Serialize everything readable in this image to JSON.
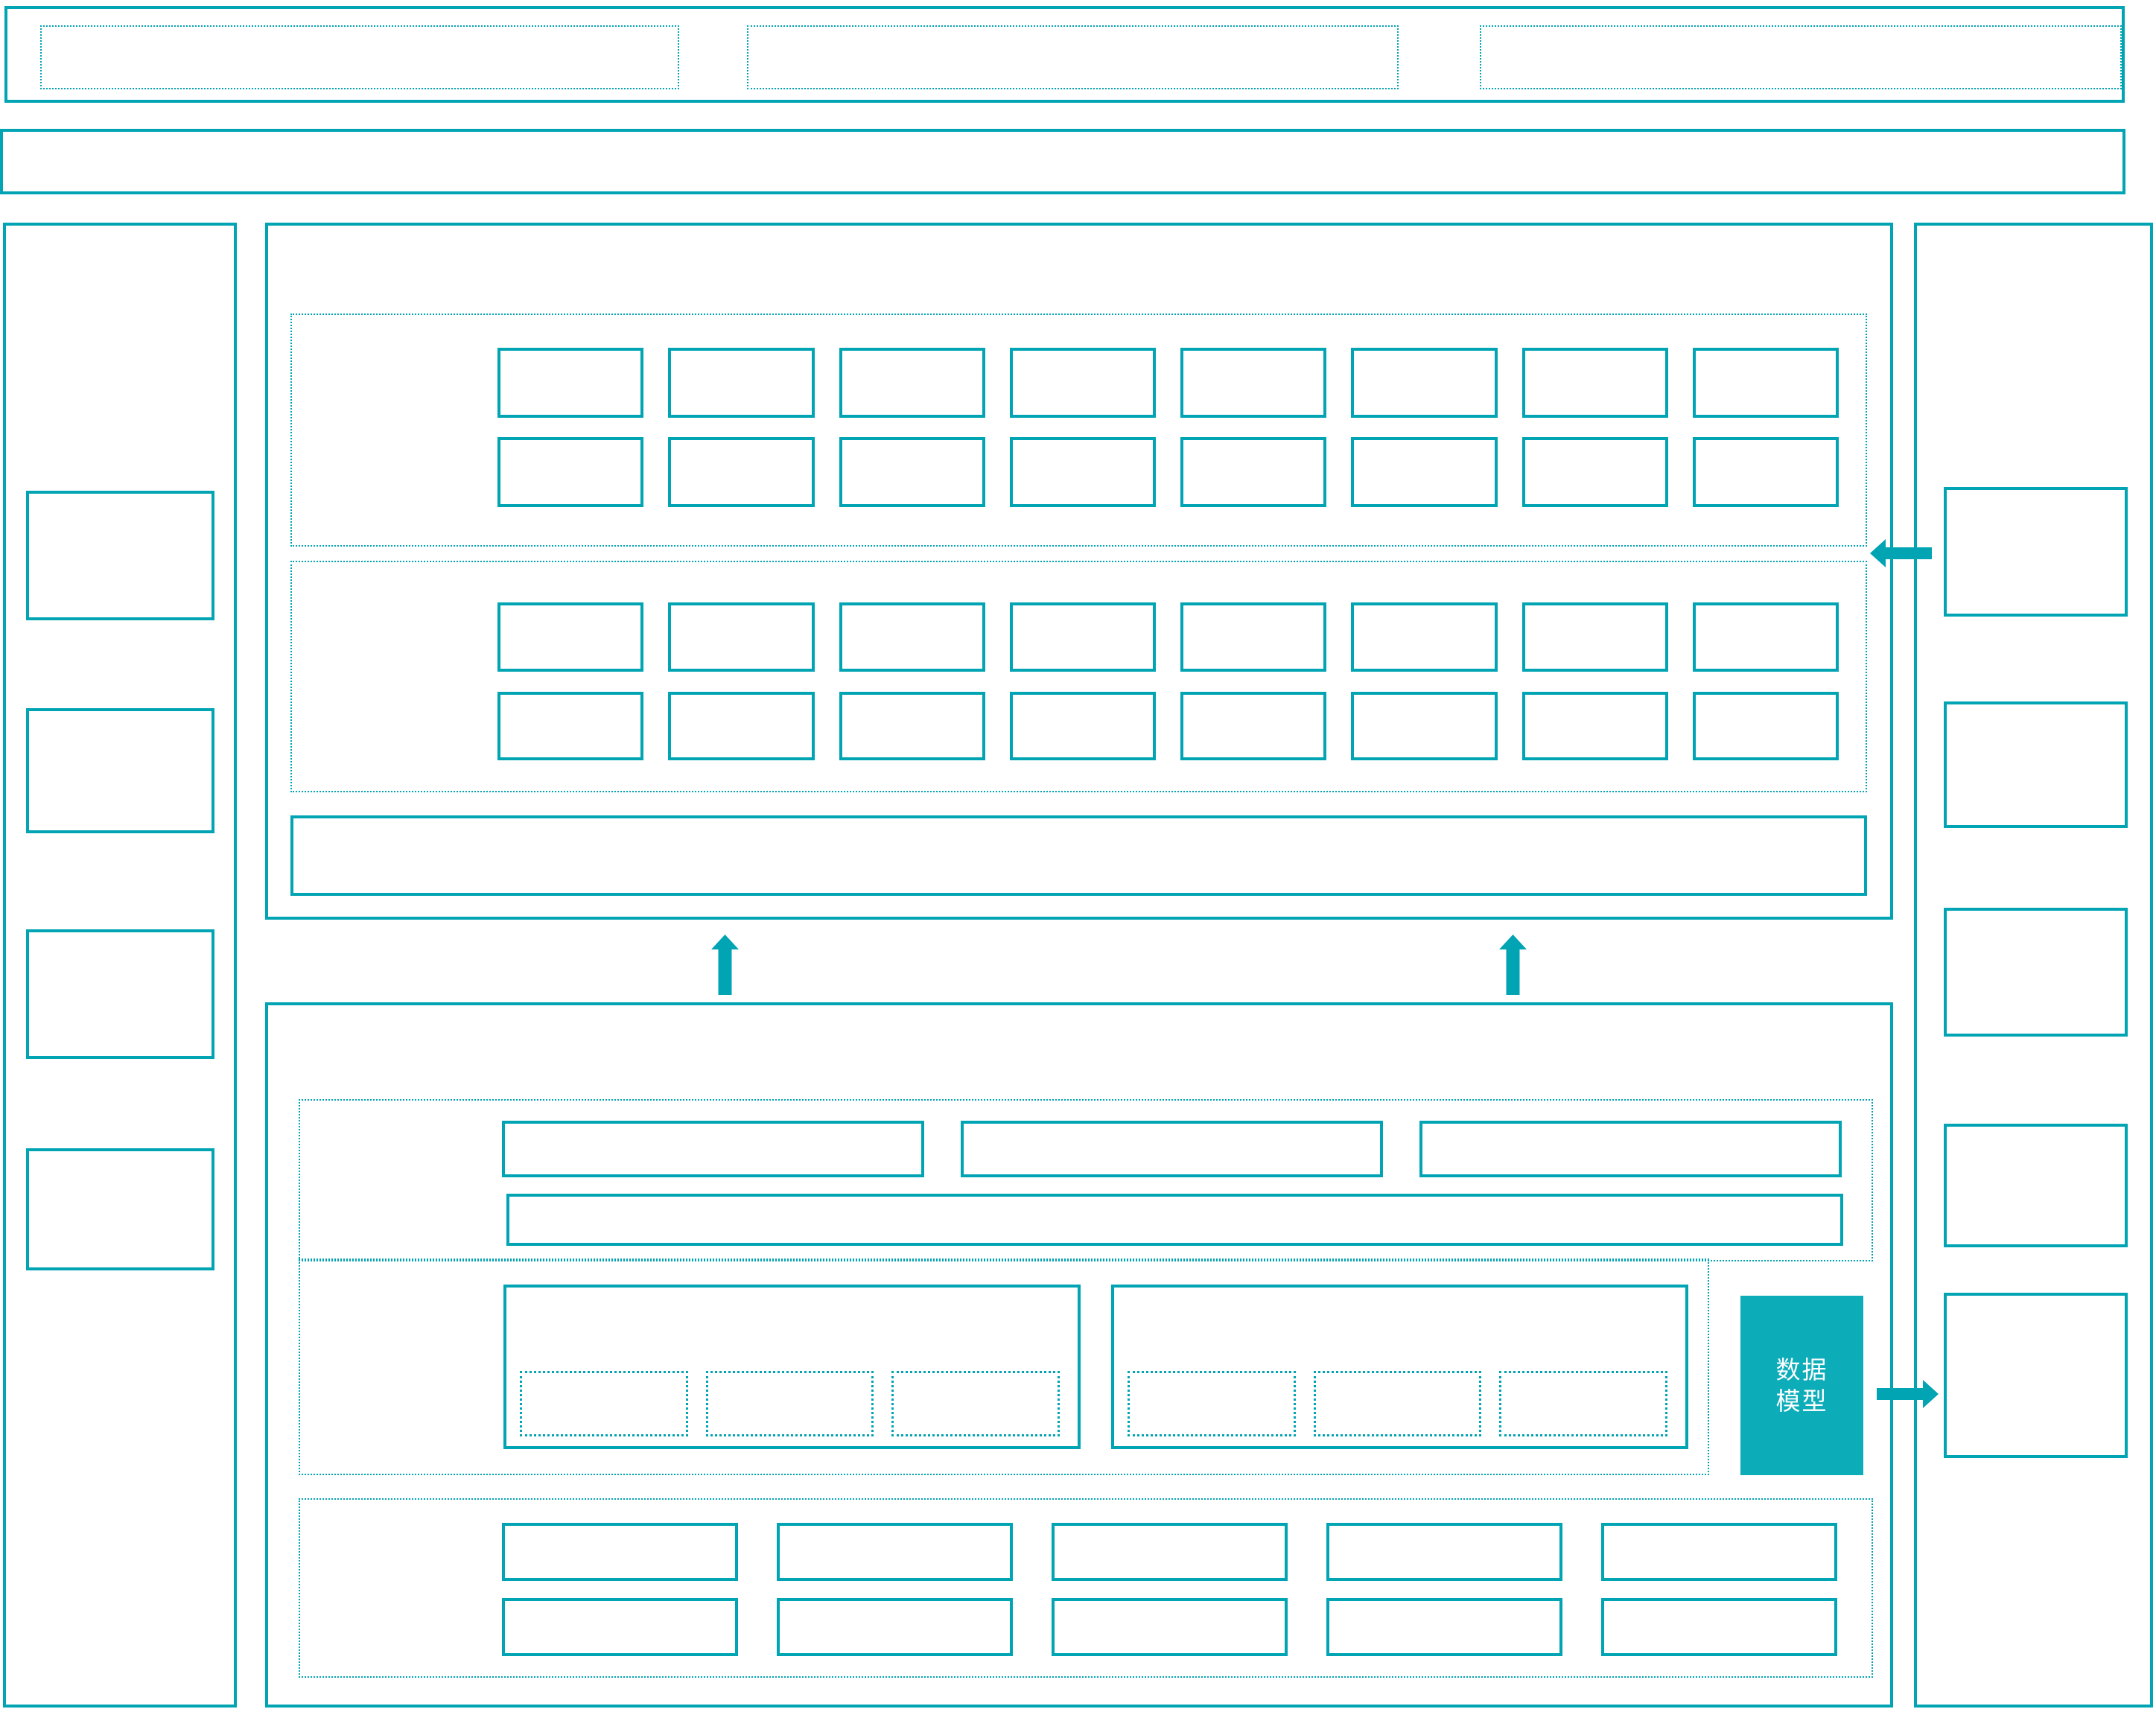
{
  "diagram": {
    "colors": {
      "accent": "#00a4b3",
      "fill": "#0cacb9",
      "label_text": "#ffffff",
      "background": "#ffffff"
    },
    "data_model_box": {
      "label": "数据\n模型"
    },
    "icons": {
      "up_arrows": "arrow-up-icon",
      "left_arrow": "arrow-left-icon",
      "right_arrow": "arrow-right-icon"
    },
    "grids": {
      "banner_slots": 3,
      "section_a_cols": 8,
      "section_b_cols": 8,
      "section_c_cols": 3,
      "module_sub_cols": 3,
      "section_e_cols": 5,
      "left_panel_boxes": 4,
      "right_panel_boxes": 5
    }
  }
}
